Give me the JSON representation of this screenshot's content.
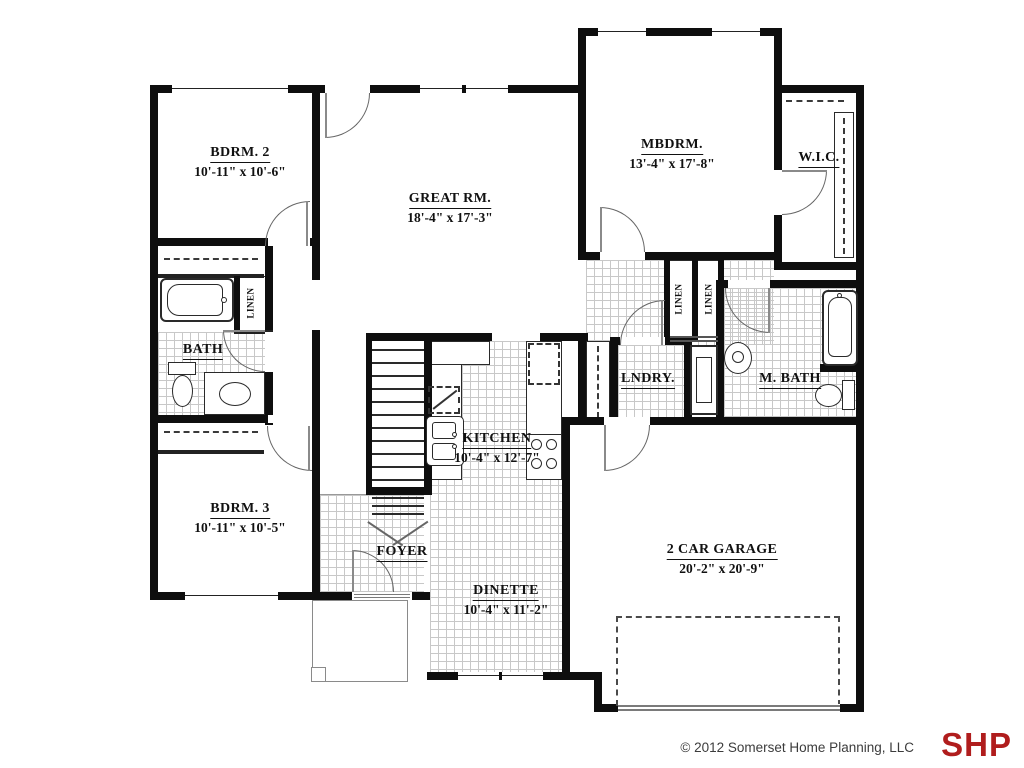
{
  "plan": {
    "rooms": [
      {
        "id": "bdrm2",
        "name": "BDRM. 2",
        "dims": "10'-11\" x 10'-6\""
      },
      {
        "id": "great",
        "name": "GREAT RM.",
        "dims": "18'-4\" x 17'-3\""
      },
      {
        "id": "mbdrm",
        "name": "MBDRM.",
        "dims": "13'-4\" x 17'-8\""
      },
      {
        "id": "wic",
        "name": "W.I.C."
      },
      {
        "id": "bath",
        "name": "BATH"
      },
      {
        "id": "lndry",
        "name": "LNDRY."
      },
      {
        "id": "mbath",
        "name": "M. BATH"
      },
      {
        "id": "bdrm3",
        "name": "BDRM. 3",
        "dims": "10'-11\" x 10'-5\""
      },
      {
        "id": "kitchen",
        "name": "KITCHEN",
        "dims": "10'-4\" x 12'-7\""
      },
      {
        "id": "foyer",
        "name": "FOYER"
      },
      {
        "id": "dinette",
        "name": "DINETTE",
        "dims": "10'-4\" x 11'-2\""
      },
      {
        "id": "garage",
        "name": "2 CAR GARAGE",
        "dims": "20'-2\" x 20'-9\""
      }
    ],
    "linen_label": "LINEN"
  },
  "footer": {
    "copyright": "© 2012 Somerset Home Planning, LLC",
    "logo": "SHP",
    "logo_color": "#b01d1d"
  }
}
